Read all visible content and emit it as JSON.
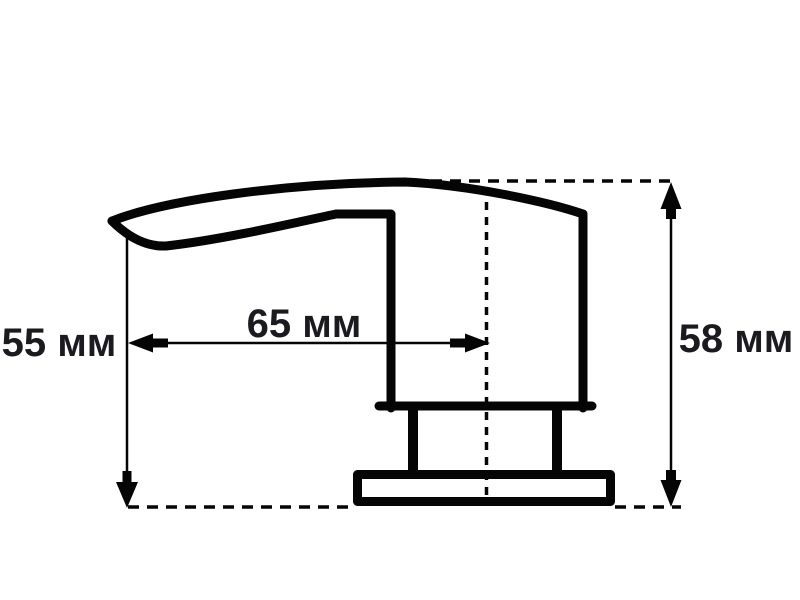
{
  "page": {
    "background": "#ffffff",
    "ink": "#050505",
    "label_color": "#1a1a1f"
  },
  "figure": {
    "kind": "technical-dimension-drawing",
    "subject": "soap-dispenser-pump-side-view"
  },
  "dimensions": {
    "left_height": {
      "label": "55 мм",
      "value": 55,
      "unit": "мм",
      "orientation": "vertical"
    },
    "spout_reach": {
      "label": "65 мм",
      "value": 65,
      "unit": "мм",
      "orientation": "horizontal"
    },
    "right_height": {
      "label": "58 мм",
      "value": 58,
      "unit": "мм",
      "orientation": "vertical"
    }
  }
}
